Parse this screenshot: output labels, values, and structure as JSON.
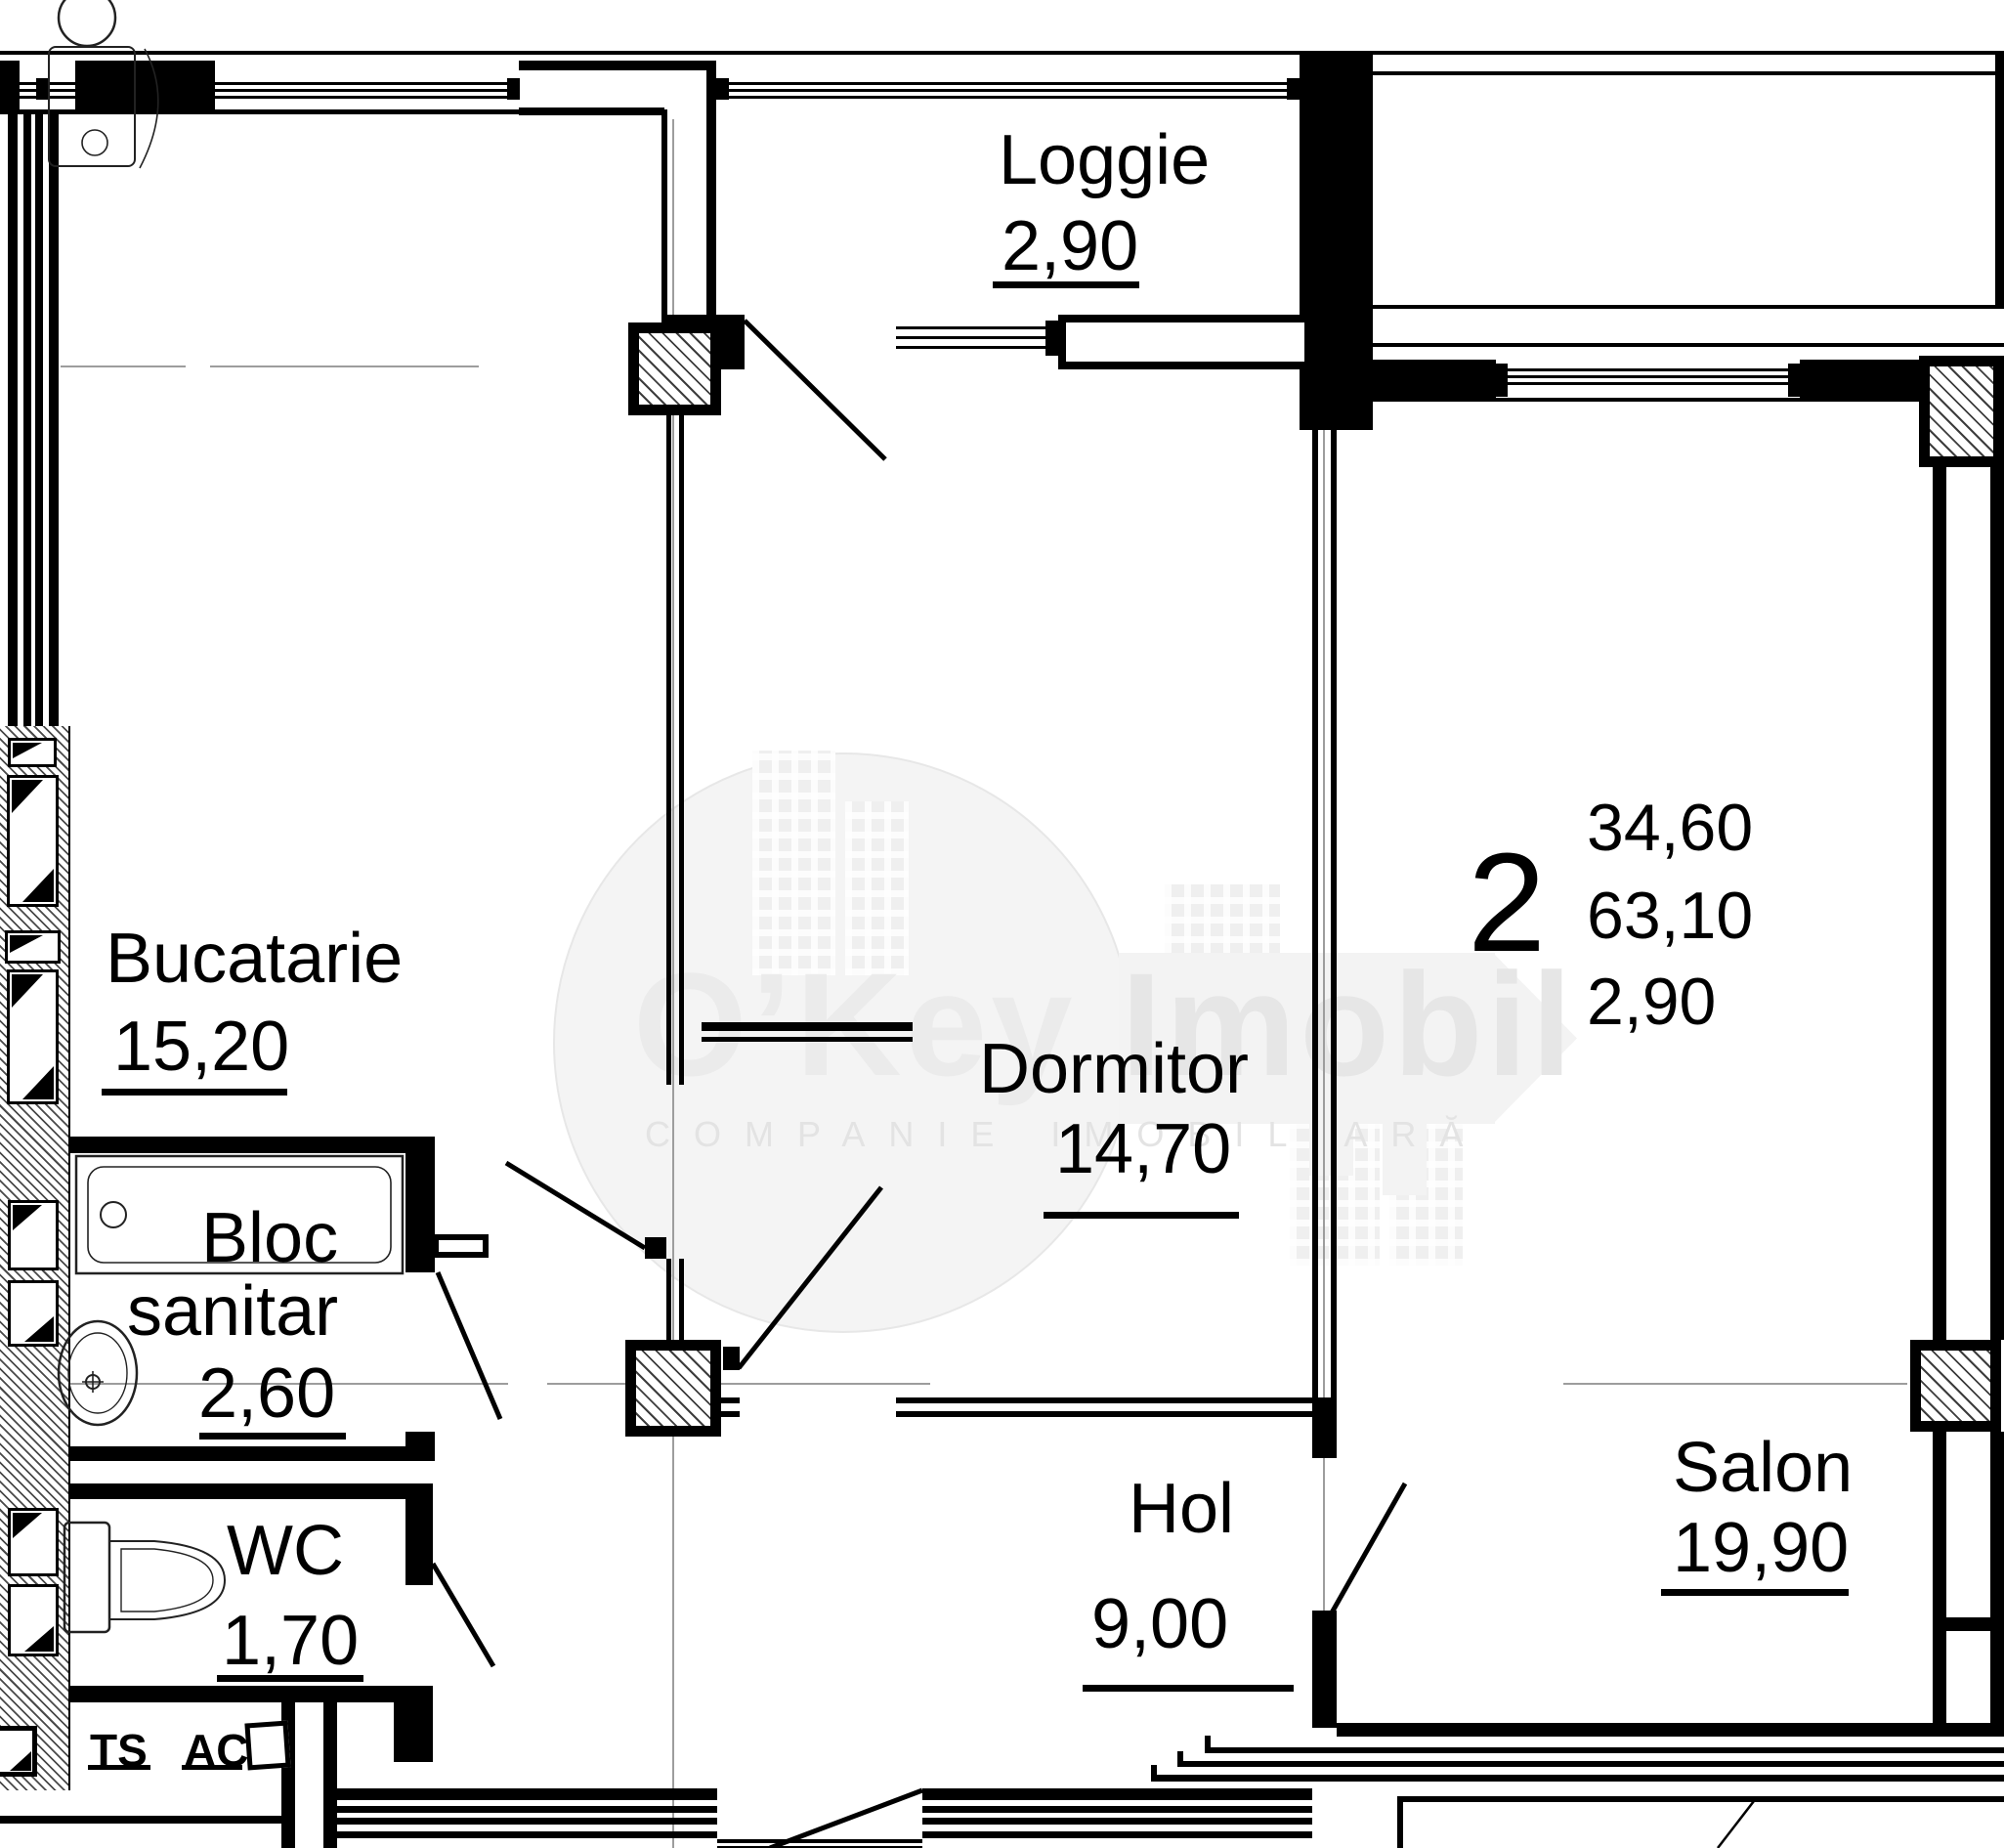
{
  "rooms": {
    "loggie": {
      "name": "Loggie",
      "area": "2,90"
    },
    "bucatarie": {
      "name": "Bucatarie",
      "area": "15,20"
    },
    "bloc_sanitar": {
      "name_line1": "Bloc",
      "name_line2": "sanitar",
      "area": "2,60"
    },
    "wc": {
      "name": "WC",
      "area": "1,70"
    },
    "dormitor": {
      "name": "Dormitor",
      "area": "14,70"
    },
    "hol": {
      "name": "Hol",
      "area": "9,00"
    },
    "salon": {
      "name": "Salon",
      "area": "19,90"
    }
  },
  "summary": {
    "room_count": "2",
    "living_area": "34,60",
    "total_area": "63,10",
    "balcony_area": "2,90"
  },
  "technical": {
    "ts_label": "TS",
    "ac_label": "AC"
  },
  "watermark": {
    "brand_first": "O’Key",
    "brand_second": "Imobil",
    "tagline": "COMPANIE IMOBILIARĂ"
  },
  "colors": {
    "line": "#000000",
    "centerline": "#9d9d9d",
    "watermark_shape": "#f3f3f3"
  }
}
